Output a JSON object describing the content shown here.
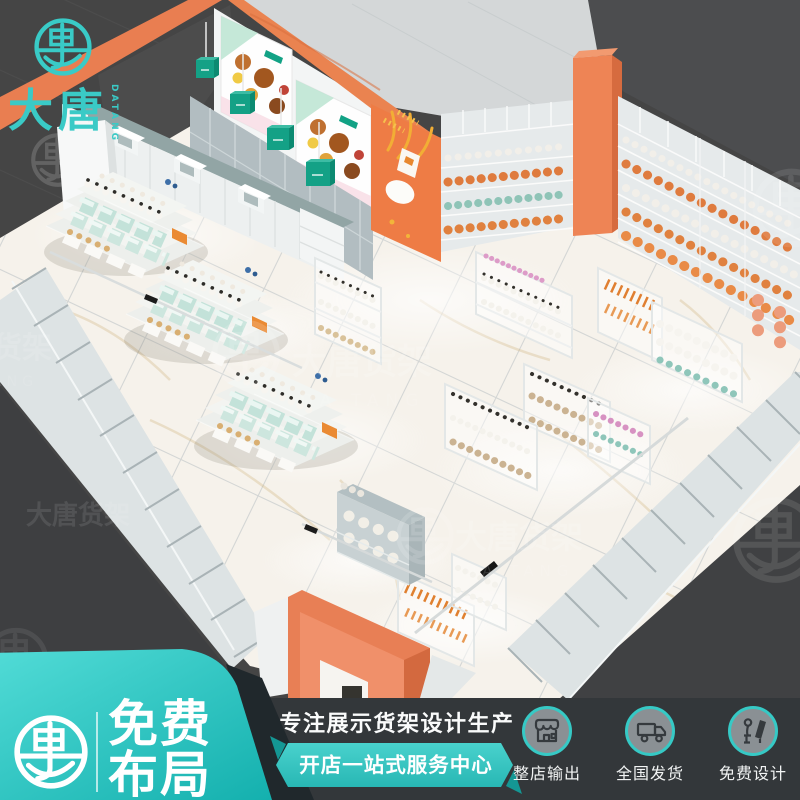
{
  "brand": {
    "logo_cn": "大唐",
    "logo_en": "DATANG",
    "watermark_cn": "大唐货架",
    "watermark_en": "DA TANG"
  },
  "footer": {
    "badge_line1": "免费",
    "badge_line2": "布局",
    "slogan_main": "专注展示货架设计生产",
    "slogan_sub": "开店一站式服务中心",
    "features": [
      {
        "icon": "storefront-icon",
        "label": "整店输出"
      },
      {
        "icon": "truck-icon",
        "label": "全国发货"
      },
      {
        "icon": "designer-icon",
        "label": "免费设计"
      }
    ]
  },
  "colors": {
    "brand_teal": "#30c8c4",
    "accent_orange": "#e87e51",
    "dark_background": "#454545",
    "footer_background": "#33373a"
  }
}
